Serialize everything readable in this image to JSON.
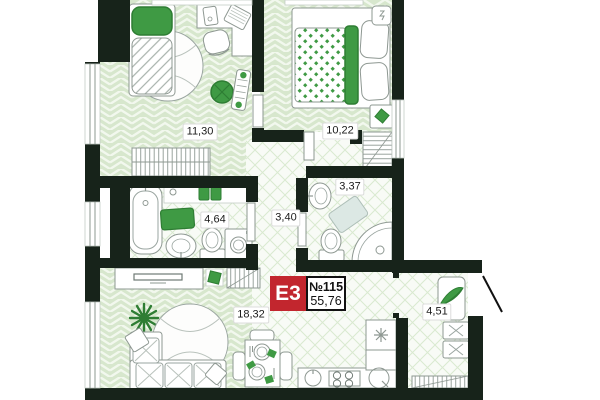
{
  "plan": {
    "unit_label": "E3",
    "unit_number": "№115",
    "total_area": "55,76",
    "rooms": [
      {
        "id": "bedroom-1",
        "area": "11,30"
      },
      {
        "id": "bedroom-2",
        "area": "10,22"
      },
      {
        "id": "bathroom",
        "area": "4,64"
      },
      {
        "id": "hallway",
        "area": "3,40"
      },
      {
        "id": "wc-shower",
        "area": "3,37"
      },
      {
        "id": "living-kitchen",
        "area": "18,32"
      },
      {
        "id": "balcony",
        "area": "4,51"
      }
    ],
    "colors": {
      "wall": "#17231a",
      "accent_green": "#3f9a44",
      "accent_green_dark": "#2e7d33",
      "badge_red": "#c2262e",
      "floor_plank_green": "#d7e7cd",
      "floor_tile_line": "#d9ead0"
    }
  }
}
